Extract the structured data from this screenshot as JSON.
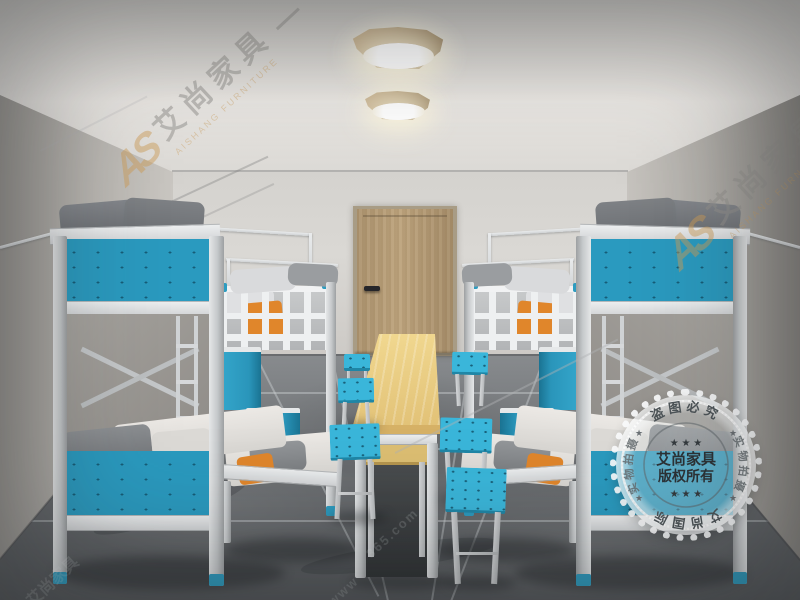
{
  "watermark": {
    "logo_text": "AS",
    "brand_cn": "艾尚家具",
    "brand_en": "AISHANG FURNITURE",
    "dash": "—",
    "url_prefix": "www",
    "url_fragment": "365.com"
  },
  "stamp": {
    "arc_top": "盗图必究",
    "arc_bottom": "艾尚国际",
    "arc_left": "实物拍摄",
    "arc_right": "实物拍摄",
    "center_line1": "艾尚家具",
    "center_line2": "版权所有",
    "stars_row": "★ ★ ★",
    "star": "★"
  },
  "palette": {
    "bed_panel_blue": "#2a9abf",
    "stool_blue": "#3ab6da",
    "frame_gray": "#d2d4d6",
    "wall_gray": "#c2bfba",
    "floor_gray": "#6e7174",
    "table_wood": "#e9cd84",
    "door_wood": "#b79d77",
    "pillow_orange": "#e0862b"
  }
}
